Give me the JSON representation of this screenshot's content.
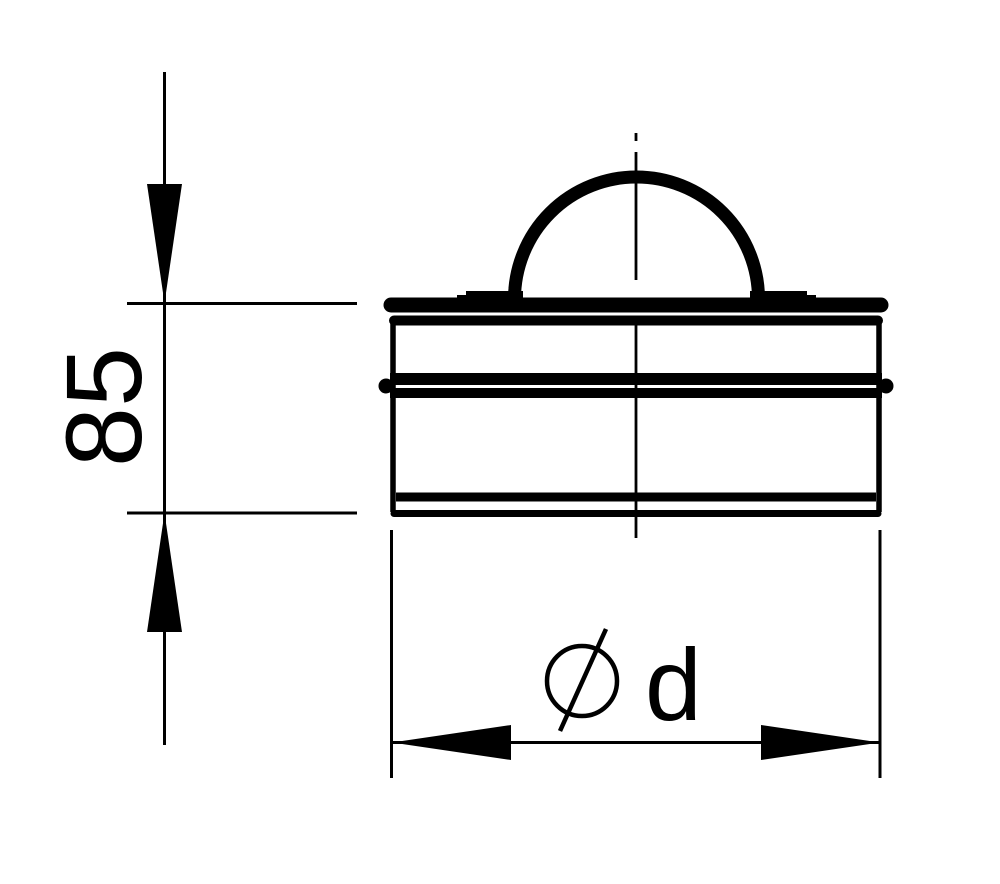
{
  "drawing": {
    "background_color": "#ffffff",
    "line_color": "#000000"
  },
  "dimensions": {
    "height": {
      "label": "85",
      "orientation": "vertical"
    },
    "diameter": {
      "label": "d",
      "symbol": "⌀",
      "orientation": "horizontal"
    }
  }
}
